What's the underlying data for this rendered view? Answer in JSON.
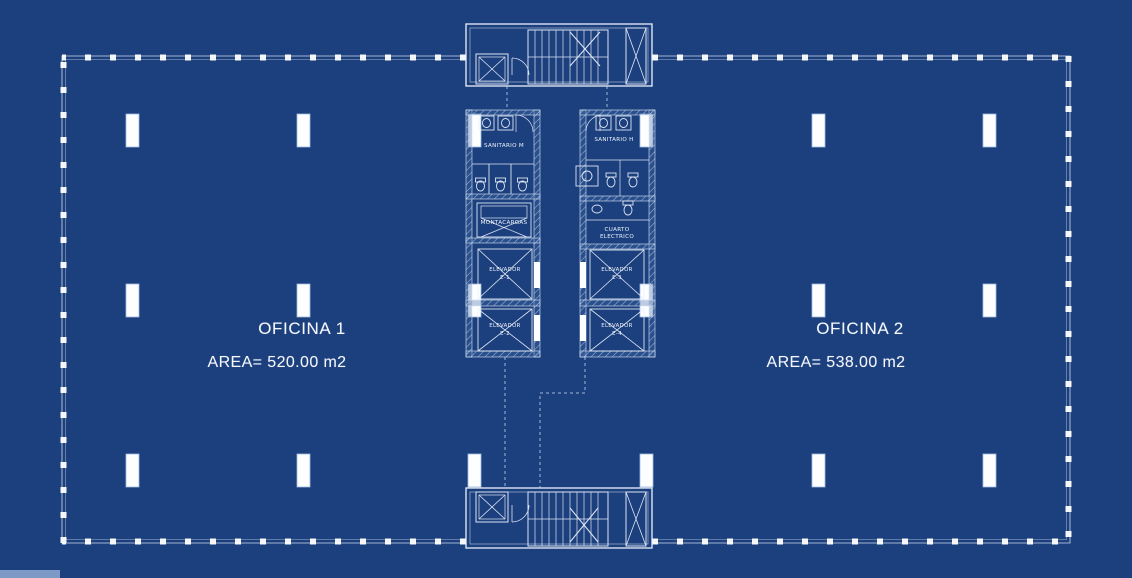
{
  "document": {
    "type": "architectural-floor-plan-blueprint",
    "style": "blueprint"
  },
  "colors": {
    "background": "#1c3f7e",
    "line": "#ffffff",
    "text": "#f4f8fd",
    "hatch": "#b9cfe8"
  },
  "offices": [
    {
      "name": "OFICINA 1",
      "area": "AREA= 520.00 m2"
    },
    {
      "name": "OFICINA 2",
      "area": "AREA= 538.00 m2"
    }
  ],
  "core": {
    "sanitario_m": "SANITARIO M",
    "sanitario_h": "SANITARIO H",
    "montacargas": "MONTACARGAS",
    "cuarto_electrico_line1": "CUARTO",
    "cuarto_electrico_line2": "ELECTRICO",
    "elevators": [
      {
        "label": "ELEVADOR",
        "number": "E-1"
      },
      {
        "label": "ELEVADOR",
        "number": "E-2"
      },
      {
        "label": "ELEVADOR",
        "number": "E-3"
      },
      {
        "label": "ELEVADOR",
        "number": "E-4"
      }
    ]
  }
}
